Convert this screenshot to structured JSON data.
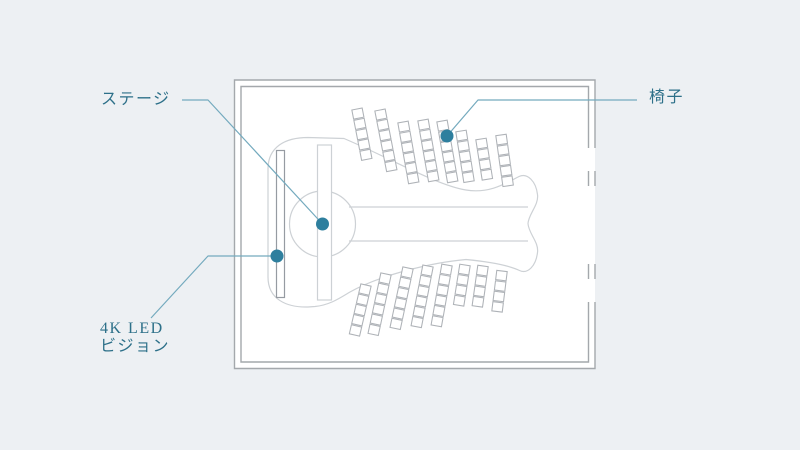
{
  "page": {
    "background": "#edf0f3"
  },
  "labels": {
    "stage": "ステージ",
    "chair": "椅子",
    "led": "4K LED\nビジョン"
  },
  "colors": {
    "accent_text": "#2d7089",
    "callout_line": "#74aabe",
    "dot": "#2e7f9e",
    "wall": "#a4a8ac",
    "plan_outline": "#cdd1d5",
    "chair_outline": "#aeb2b7",
    "led_outline": "#969ba2"
  },
  "floor_plan": {
    "chairs": {
      "square_w": 10.5,
      "square_h": 9.3,
      "pitch": 10.5,
      "top_rows": [
        {
          "x": 357,
          "y": 109,
          "n": 5,
          "angle": -11
        },
        {
          "x": 380,
          "y": 110,
          "n": 6,
          "angle": -11
        },
        {
          "x": 403,
          "y": 122,
          "n": 6,
          "angle": -10
        },
        {
          "x": 423,
          "y": 120,
          "n": 6,
          "angle": -10
        },
        {
          "x": 442,
          "y": 121,
          "n": 6,
          "angle": -10
        },
        {
          "x": 461,
          "y": 131,
          "n": 5,
          "angle": -9
        },
        {
          "x": 481,
          "y": 139,
          "n": 4,
          "angle": -9
        },
        {
          "x": 501,
          "y": 135,
          "n": 5,
          "angle": -8
        }
      ],
      "bottom_rows": [
        {
          "x": 366,
          "y": 285,
          "n": 5,
          "angle": 13
        },
        {
          "x": 386,
          "y": 274,
          "n": 6,
          "angle": 12
        },
        {
          "x": 408,
          "y": 268,
          "n": 6,
          "angle": 12
        },
        {
          "x": 428,
          "y": 266,
          "n": 6,
          "angle": 11
        },
        {
          "x": 447,
          "y": 265,
          "n": 6,
          "angle": 10
        },
        {
          "x": 465,
          "y": 265,
          "n": 4,
          "angle": 9
        },
        {
          "x": 483,
          "y": 266,
          "n": 4,
          "angle": 8
        },
        {
          "x": 502,
          "y": 271,
          "n": 4,
          "angle": 7
        }
      ]
    }
  }
}
